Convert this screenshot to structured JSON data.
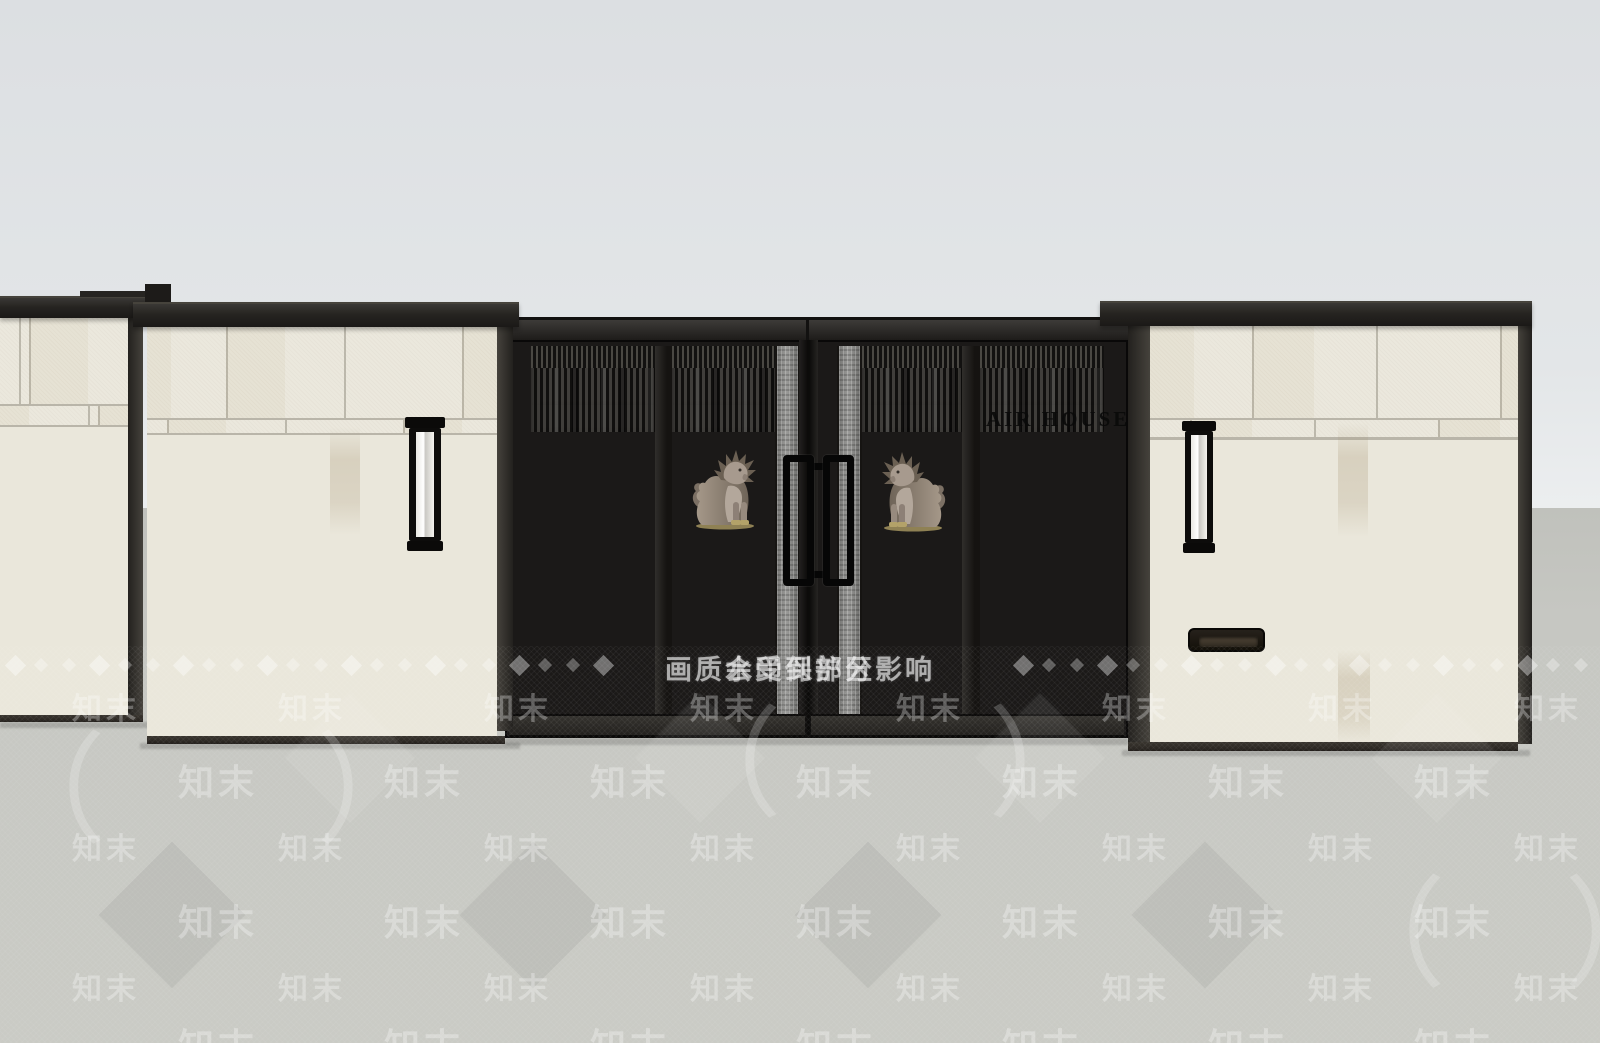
{
  "sign": {
    "text": "AIR HOUSE"
  },
  "watermark": {
    "zone_label": "水印保护区",
    "quality_note": "画质会受到部分影响",
    "brand": "知末",
    "bullet": "◆",
    "paren_open": "（",
    "paren_close": "）"
  },
  "scene": {
    "description": "3D elevation render of a modern residential entrance: stone-clad pillars, black vertical-slat double gate with guardian lion statues, wall lamps and a mail slot",
    "colors": {
      "sky_top": "#dcdfe2",
      "sky_bottom": "#eef0f1",
      "ground": "#c6c7c2",
      "stone": "#eae7db",
      "grout": "#b9b5a9",
      "cap_dark": "#262421",
      "gate_frame": "#1b1918",
      "slat_light": "#403e3b",
      "slat_gap": "#100f0e",
      "glass_strip": "#878785",
      "handle": "#060606",
      "lamp_glow": "#f6f5f1",
      "lion_body": "#9a8d81",
      "lion_base": "#a8975e",
      "sign_text": "#0c0c0c",
      "watermark_white": "rgba(255,255,255,0.55)"
    }
  }
}
